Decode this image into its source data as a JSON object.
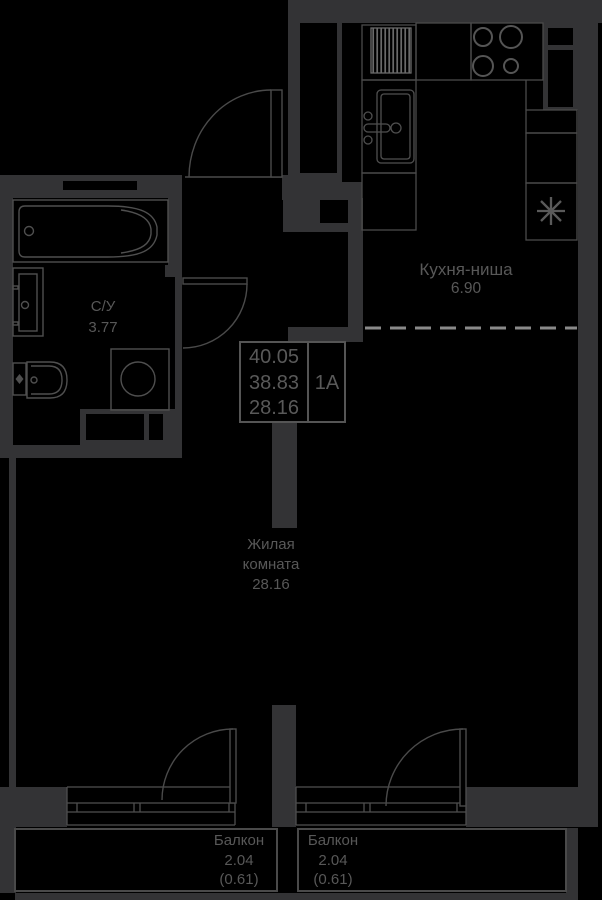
{
  "unit": {
    "areas": [
      "40.05",
      "38.83",
      "28.16"
    ],
    "type": "1А"
  },
  "rooms": {
    "kitchen": {
      "name": "Кухня-ниша",
      "area": "6.90"
    },
    "bathroom": {
      "name": "С/У",
      "area": "3.77"
    },
    "living": {
      "name": "Жилая комната",
      "area": "28.16"
    },
    "balcony_left": {
      "name": "Балкон",
      "area": "2.04",
      "area_reduced": "(0.61)"
    },
    "balcony_right": {
      "name": "Балкон",
      "area": "2.04",
      "area_reduced": "(0.61)"
    }
  },
  "colors": {
    "background": "#000000",
    "wall": "#333335",
    "fixture_line": "#4f4f4f",
    "dashed_line": "#8a8a8a",
    "text": "#585858"
  }
}
